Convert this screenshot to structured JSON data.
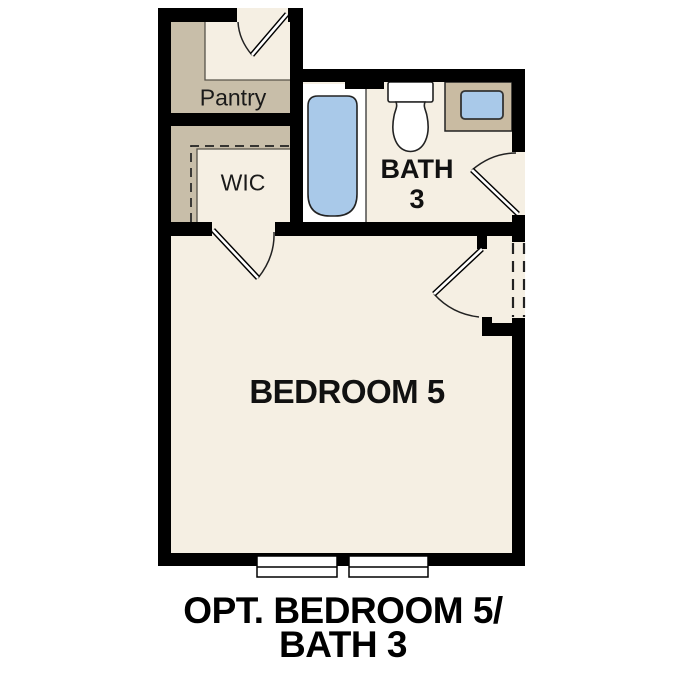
{
  "plan": {
    "title": "Optional Bedroom 5 / Bath 3 floor plan",
    "rooms": {
      "pantry": {
        "label": "Pantry"
      },
      "wic": {
        "label": "WIC"
      },
      "bath": {
        "line1": "BATH",
        "line2": "3"
      },
      "bedroom": {
        "label": "BEDROOM 5"
      }
    },
    "caption": {
      "line1": "OPT. BEDROOM 5/",
      "line2": "BATH 3"
    },
    "fixtures": [
      {
        "name": "bathtub-icon"
      },
      {
        "name": "toilet-icon"
      },
      {
        "name": "vanity-sink-icon"
      },
      {
        "name": "window-icon"
      },
      {
        "name": "window-icon"
      },
      {
        "name": "door-swing-icon"
      },
      {
        "name": "dashed-opening-icon"
      }
    ],
    "colors": {
      "wall": "#000000",
      "floor": "#f5efe3",
      "closet_shade": "#c8bea9",
      "vanity": "#c9bba2",
      "fixture_blue": "#a9c9e9",
      "outline": "#222222",
      "text": "#1a1a1a",
      "background": "#ffffff"
    }
  }
}
